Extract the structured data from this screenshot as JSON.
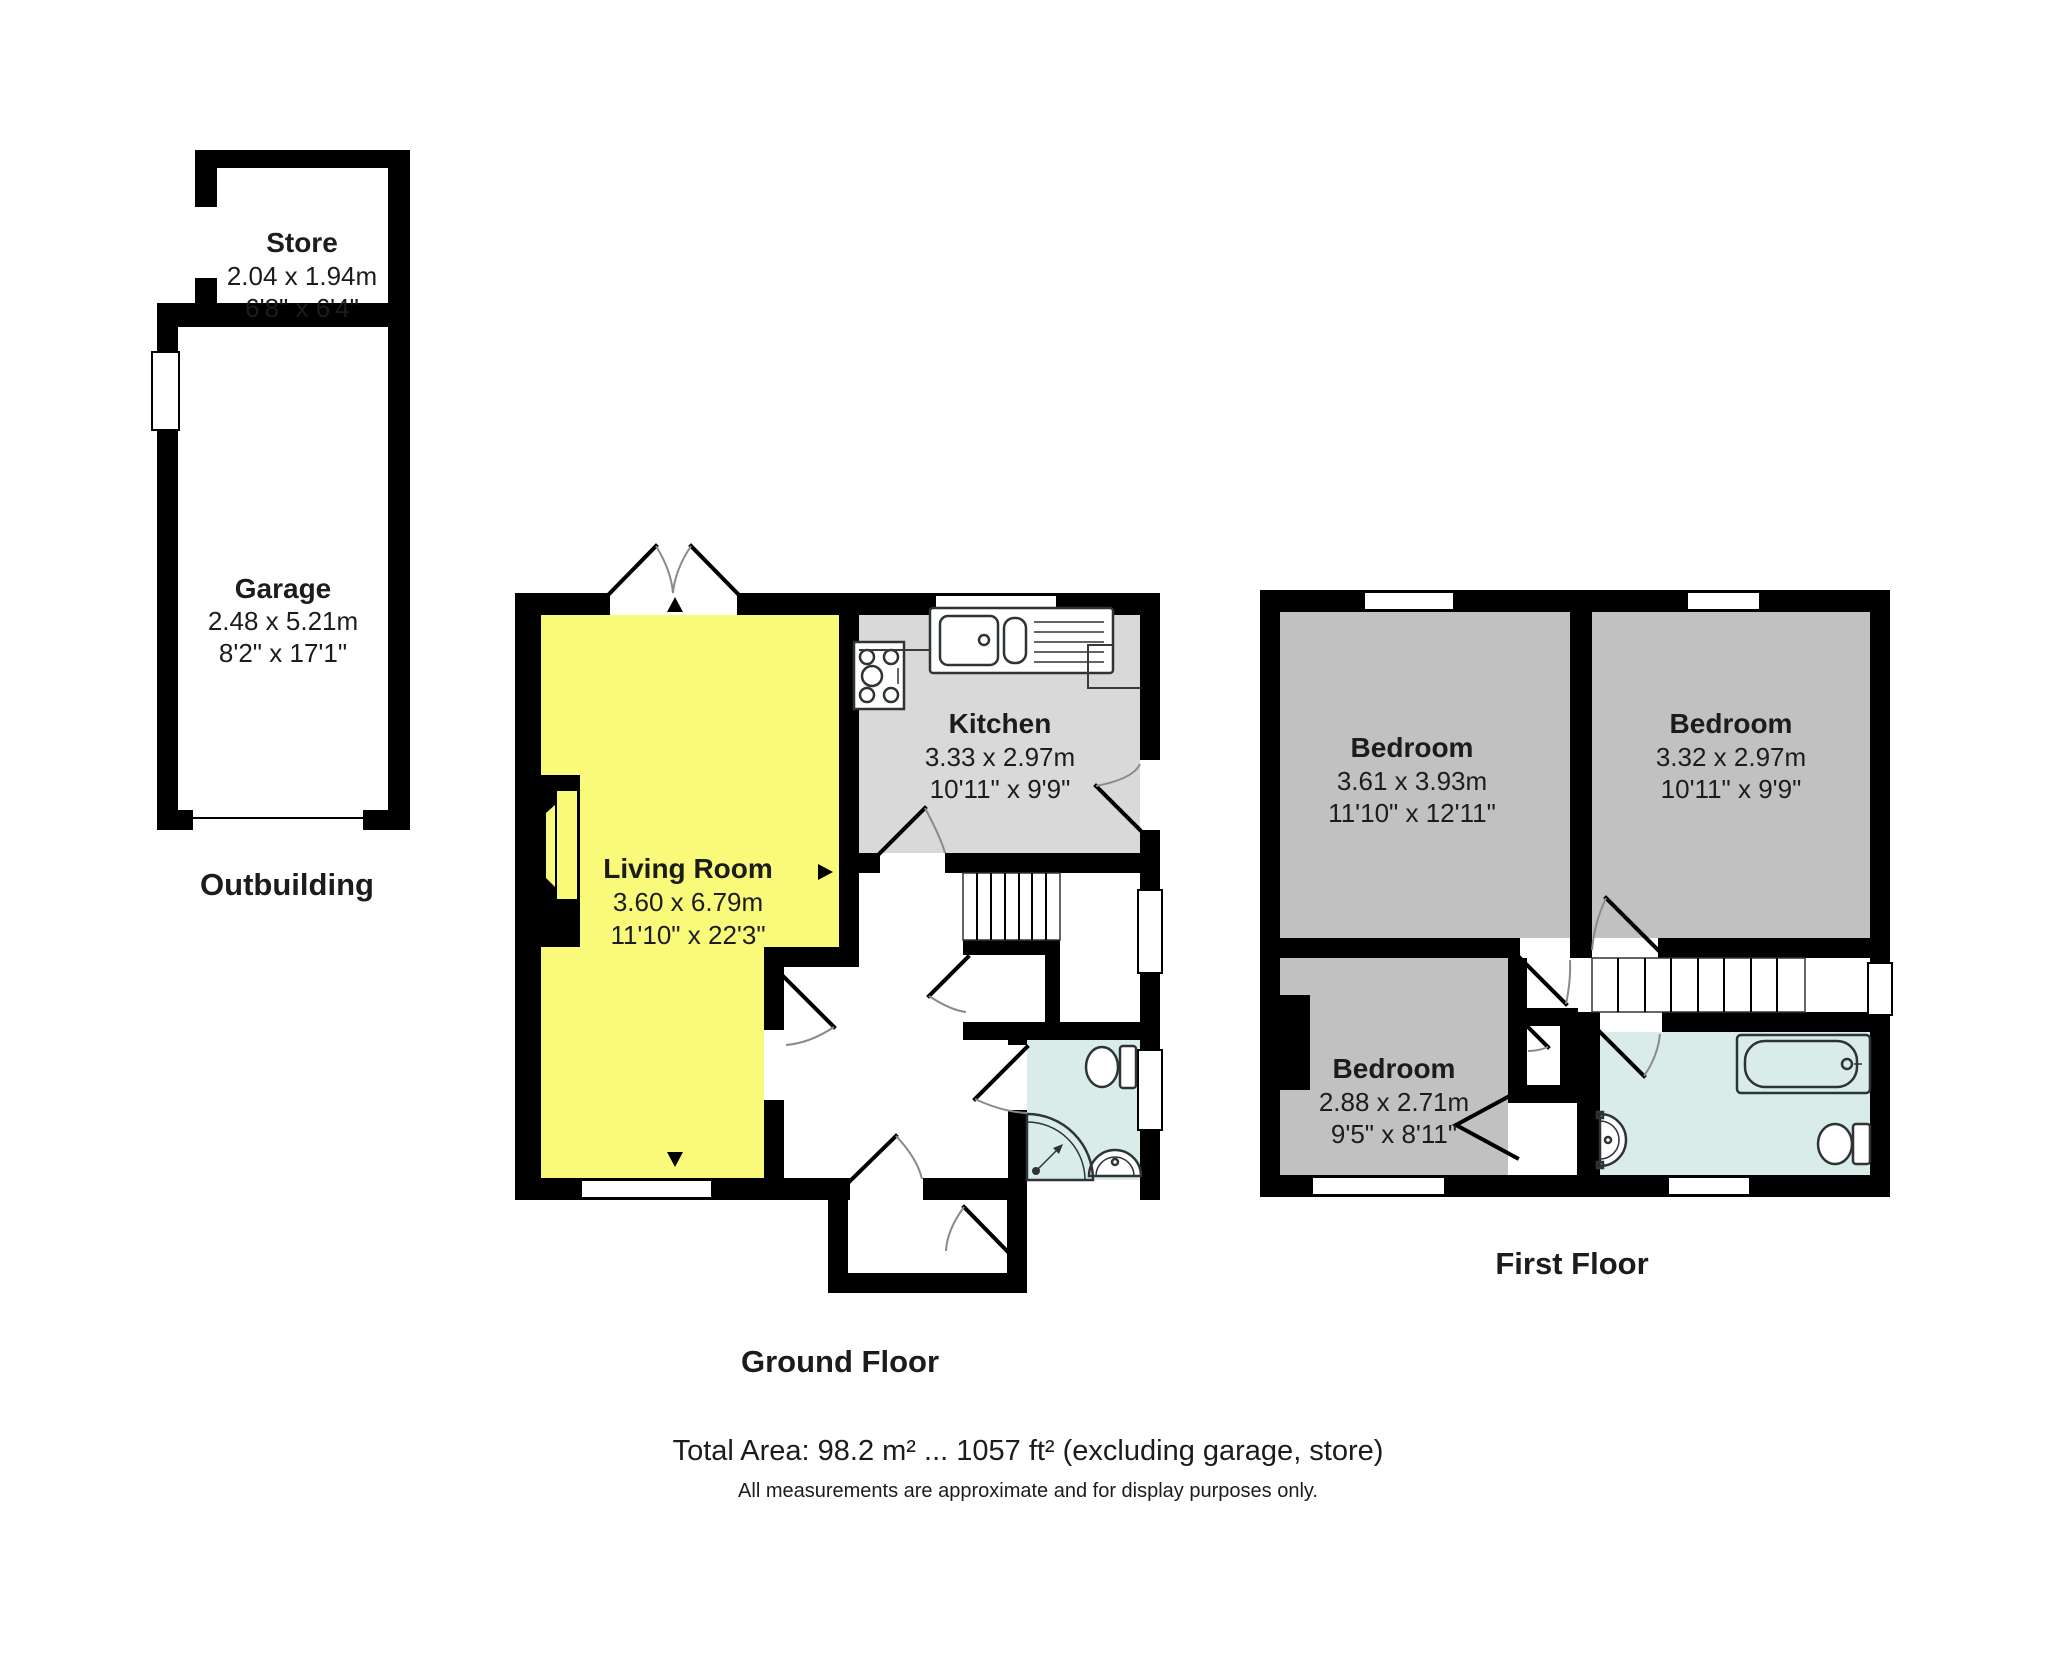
{
  "colors": {
    "living_room": "#f9f97a",
    "kitchen": "#d9d9d9",
    "bedroom": "#c1c1c1",
    "bathroom": "#d9ecea",
    "wall": "#000000"
  },
  "outbuilding": {
    "label": "Outbuilding",
    "store": {
      "name": "Store",
      "metric": "2.04 x 1.94m",
      "imperial": "6'8\" x 6'4\""
    },
    "garage": {
      "name": "Garage",
      "metric": "2.48 x 5.21m",
      "imperial": "8'2\" x 17'1\""
    }
  },
  "ground_floor": {
    "label": "Ground Floor",
    "living_room": {
      "name": "Living Room",
      "metric": "3.60 x 6.79m",
      "imperial": "11'10\" x 22'3\""
    },
    "kitchen": {
      "name": "Kitchen",
      "metric": "3.33 x 2.97m",
      "imperial": "10'11\" x 9'9\""
    }
  },
  "first_floor": {
    "label": "First Floor",
    "bedroom_left": {
      "name": "Bedroom",
      "metric": "3.61 x 3.93m",
      "imperial": "11'10\" x 12'11\""
    },
    "bedroom_right": {
      "name": "Bedroom",
      "metric": "3.32 x 2.97m",
      "imperial": "10'11\" x 9'9\""
    },
    "bedroom_small": {
      "name": "Bedroom",
      "metric": "2.88 x 2.71m",
      "imperial": "9'5\" x 8'11\""
    }
  },
  "footer": {
    "total_area": "Total Area: 98.2 m² ... 1057 ft² (excluding garage, store)",
    "disclaimer": "All measurements are approximate and for display purposes only."
  }
}
